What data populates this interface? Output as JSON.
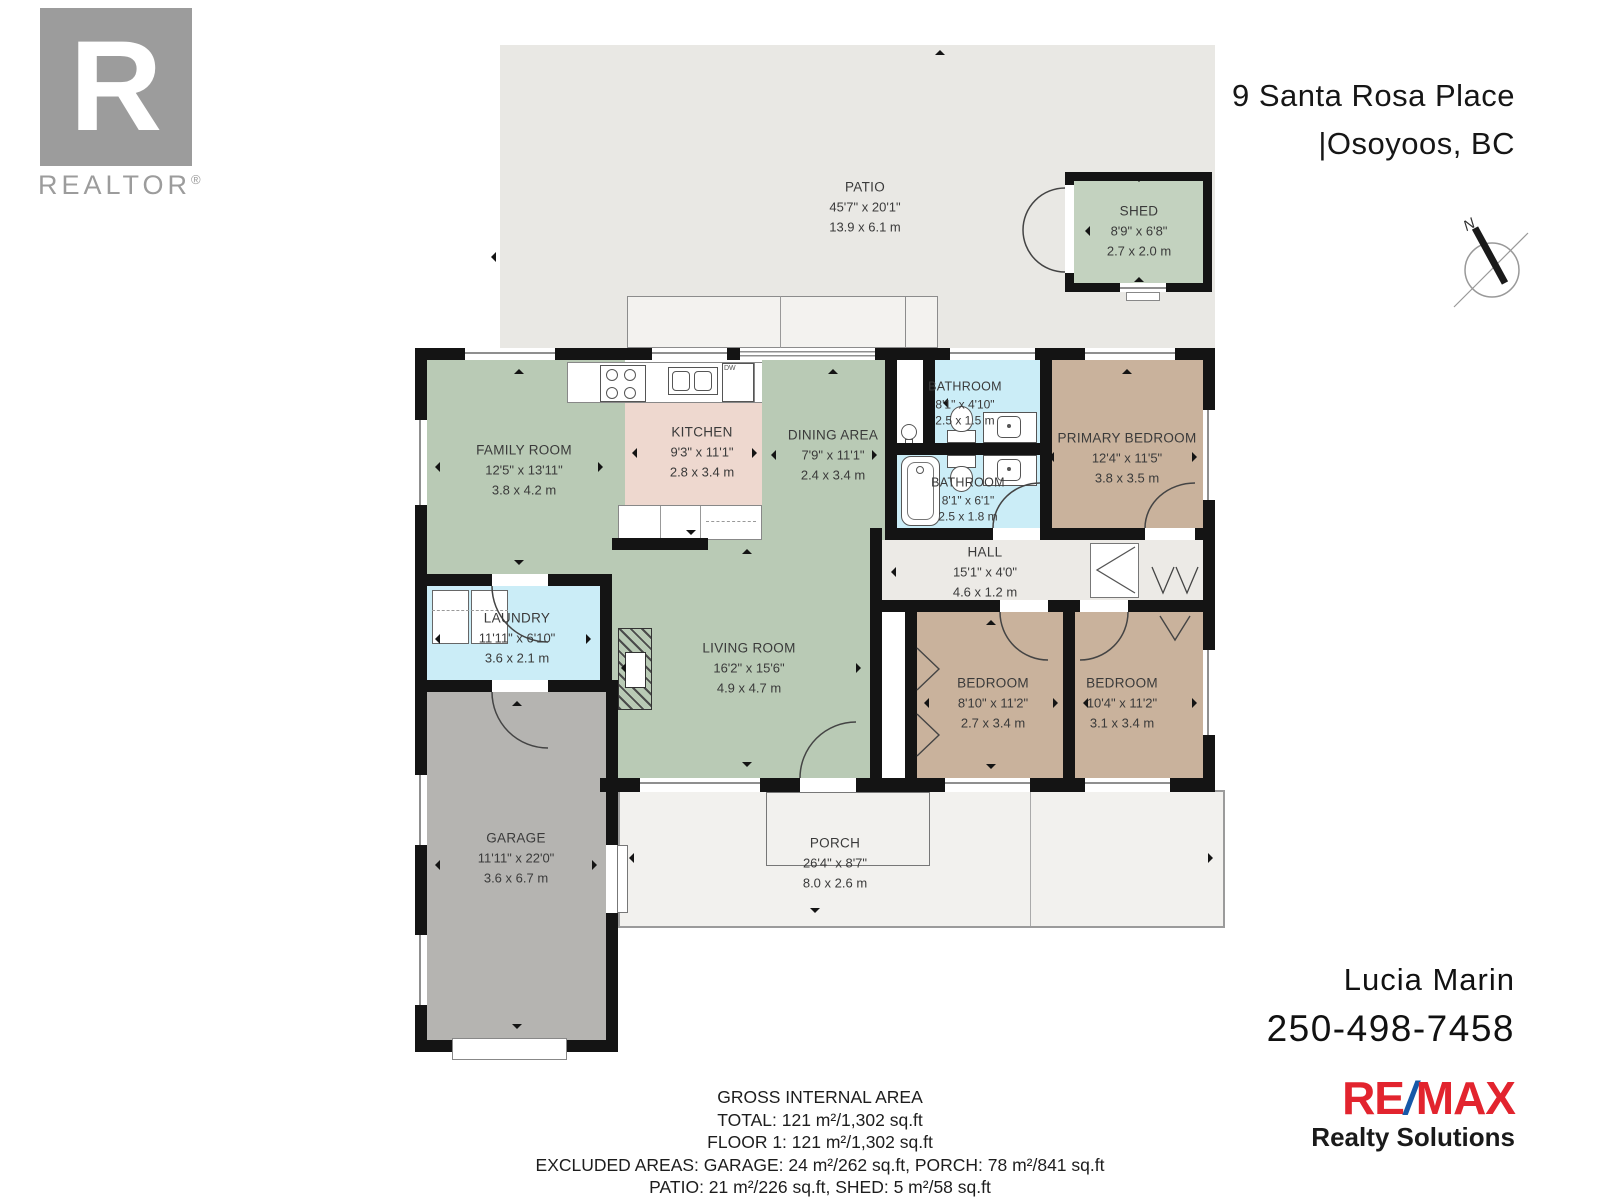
{
  "header": {
    "realtor_letter": "R",
    "realtor_word": "REALTOR",
    "realtor_reg": "®",
    "address_line1": "9 Santa Rosa Place",
    "address_line2": "|Osoyoos, BC",
    "compass_n": "N"
  },
  "rooms": {
    "patio": {
      "name": "PATIO",
      "ft": "45'7\" x 20'1\"",
      "m": "13.9 x 6.1 m"
    },
    "shed": {
      "name": "SHED",
      "ft": "8'9\" x 6'8\"",
      "m": "2.7 x 2.0 m"
    },
    "family": {
      "name": "FAMILY ROOM",
      "ft": "12'5\" x 13'11\"",
      "m": "3.8 x 4.2 m"
    },
    "kitchen": {
      "name": "KITCHEN",
      "ft": "9'3\" x 11'1\"",
      "m": "2.8 x 3.4 m"
    },
    "dining": {
      "name": "DINING AREA",
      "ft": "7'9\" x 11'1\"",
      "m": "2.4 x 3.4 m"
    },
    "bath1": {
      "name": "BATHROOM",
      "ft": "8'1\" x 4'10\"",
      "m": "2.5 x 1.5 m"
    },
    "bath2": {
      "name": "BATHROOM",
      "ft": "8'1\" x 6'1\"",
      "m": "2.5 x 1.8 m"
    },
    "primary": {
      "name": "PRIMARY BEDROOM",
      "ft": "12'4\" x 11'5\"",
      "m": "3.8 x 3.5 m"
    },
    "hall": {
      "name": "HALL",
      "ft": "15'1\" x 4'0\"",
      "m": "4.6 x 1.2 m"
    },
    "laundry": {
      "name": "LAUNDRY",
      "ft": "11'11\" x 6'10\"",
      "m": "3.6 x 2.1 m"
    },
    "living": {
      "name": "LIVING ROOM",
      "ft": "16'2\" x 15'6\"",
      "m": "4.9 x 4.7 m"
    },
    "bedroom1": {
      "name": "BEDROOM",
      "ft": "8'10\" x 11'2\"",
      "m": "2.7 x 3.4 m"
    },
    "bedroom2": {
      "name": "BEDROOM",
      "ft": "10'4\" x 11'2\"",
      "m": "3.1 x 3.4 m"
    },
    "garage": {
      "name": "GARAGE",
      "ft": "11'11\" x 22'0\"",
      "m": "3.6 x 6.7 m"
    },
    "porch": {
      "name": "PORCH",
      "ft": "26'4\" x 8'7\"",
      "m": "8.0 x 2.6 m"
    }
  },
  "fixtures": {
    "dw_label": "DW"
  },
  "area_summary": {
    "title": "GROSS INTERNAL AREA",
    "total": "TOTAL: 121 m²/1,302 sq.ft",
    "floor1": "FLOOR 1: 121 m²/1,302 sq.ft",
    "excluded1": "EXCLUDED AREAS: GARAGE: 24 m²/262 sq.ft, PORCH: 78 m²/841 sq.ft",
    "excluded2": "PATIO: 21 m²/226 sq.ft, SHED: 5 m²/58 sq.ft",
    "disclaimer": "SIZE AND DIMENSIONS ARE APPROXIMATE, ACTUAL MAY VARY"
  },
  "agent": {
    "name": "Lucia Marin",
    "phone": "250-498-7458",
    "brand_re": "RE",
    "brand_slash": "/",
    "brand_max": "MAX",
    "brand_sub": "Realty Solutions"
  },
  "colors": {
    "wall": "#141414",
    "patio": "#e9e8e4",
    "green_room": "#b9cab5",
    "shed_green": "#c3d2bf",
    "kitchen_pink": "#eed8cf",
    "wet_blue": "#cbedf7",
    "bedroom_tan": "#c9b29c",
    "garage_gray": "#b5b4b1",
    "hall_gray": "#eceae6",
    "remax_red": "#e2242e",
    "remax_blue": "#1658a8",
    "logo_gray": "#9c9c9c"
  }
}
